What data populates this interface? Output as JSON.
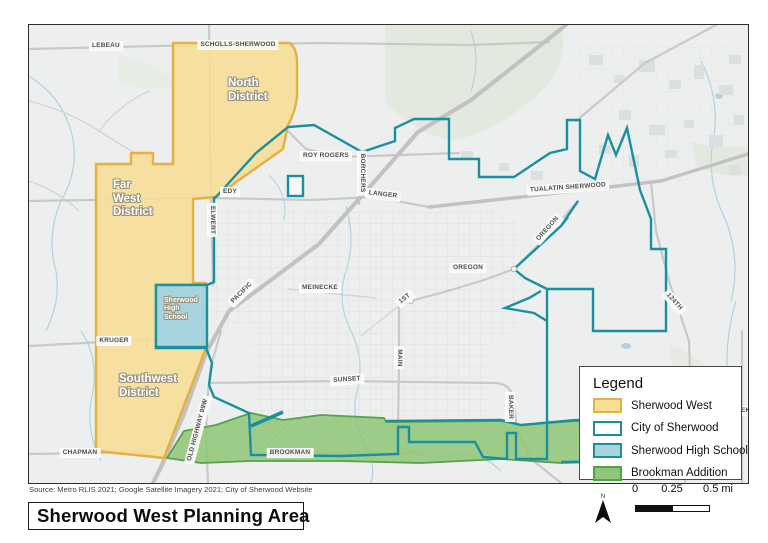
{
  "title": "Sherwood West Planning Area",
  "source": "Source: Metro RLIS 2021; Google Satellite Imagery 2021; City of Sherwood Website",
  "north_label": "N",
  "scale_bar": {
    "zero": "0",
    "quarter": "0.25",
    "half": "0.5 mi"
  },
  "legend": {
    "title": "Legend",
    "items": [
      {
        "label": "Sherwood West"
      },
      {
        "label": "City of Sherwood"
      },
      {
        "label": "Sherwood High School"
      },
      {
        "label": "Brookman Addition"
      }
    ]
  },
  "map": {
    "districts": [
      {
        "label": "North\nDistrict"
      },
      {
        "label": "Far\nWest\nDistrict"
      },
      {
        "label": "Southwest\nDistrict"
      },
      {
        "label": "Sherwood\nHigh\nSchool"
      }
    ],
    "road_labels": [
      {
        "label": "LEBEAU"
      },
      {
        "label": "SCHOLLS-SHERWOOD"
      },
      {
        "label": "ROY ROGERS"
      },
      {
        "label": "EDY"
      },
      {
        "label": "ELWERT"
      },
      {
        "label": "BORCHERS"
      },
      {
        "label": "LANGER"
      },
      {
        "label": "TUALATIN SHERWOOD"
      },
      {
        "label": "OREGON"
      },
      {
        "label": "OREGON"
      },
      {
        "label": "MEINECKE"
      },
      {
        "label": "1ST"
      },
      {
        "label": "PACIFIC"
      },
      {
        "label": "MAIN"
      },
      {
        "label": "SUNSET"
      },
      {
        "label": "KRUGER"
      },
      {
        "label": "CHAPMAN"
      },
      {
        "label": "OLD HIGHWAY 99W"
      },
      {
        "label": "BROOKMAN"
      },
      {
        "label": "BAKER"
      },
      {
        "label": "124TH"
      },
      {
        "label": "REEK"
      }
    ]
  },
  "colors": {
    "map_bg": "#edefee",
    "forest": "#e3e9df",
    "water": "#aed2e3",
    "road_major": "#c2c2c2",
    "road_medium": "#c9c9c9",
    "road_minor": "#d4d6d6",
    "sherwood_west_fill": "#f8df97",
    "sherwood_west_border": "#e5b145",
    "city_stroke": "#1b8fa0",
    "school_fill": "#a8d5dd",
    "brookman_fill": "#8fc778",
    "brookman_border": "#55a149"
  }
}
